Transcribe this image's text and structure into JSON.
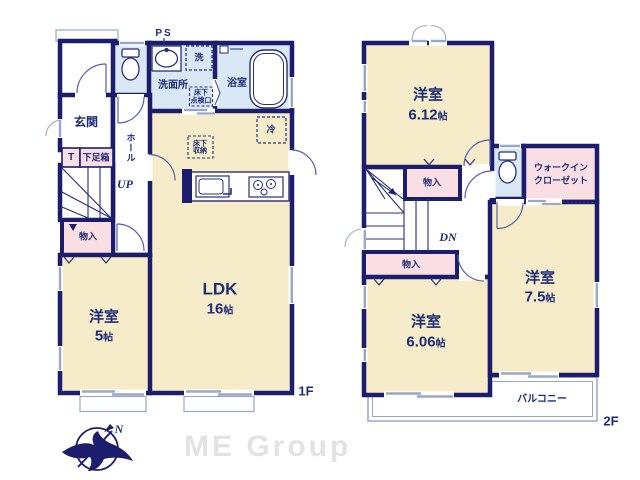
{
  "colors": {
    "wall": "#1d1d6e",
    "room_yellow": "#f7ecca",
    "room_pink": "#f9dee3",
    "room_blue": "#d9e8f4",
    "window_gray": "#9aa8c8",
    "text_navy": "#1e2d78",
    "logo_gray": "#e3e3e3"
  },
  "floor1": {
    "floor_label": "1F",
    "labels": {
      "ps": "PS",
      "entrance": "玄関",
      "t": "T",
      "shoe_box": "下足箱",
      "hall": "ホール",
      "up": "UP",
      "storage": "物入",
      "washroom": "洗面所",
      "laundry": "洗",
      "floor_hatch_line1": "床下",
      "floor_hatch_line2": "点検口",
      "bath": "浴室",
      "fridge": "冷",
      "underfloor_line1": "床下",
      "underfloor_line2": "収納"
    },
    "rooms": {
      "western5": {
        "name": "洋室",
        "size_num": "5",
        "size_unit": "帖"
      },
      "ldk": {
        "name": "LDK",
        "size_num": "16",
        "size_unit": "帖"
      }
    }
  },
  "floor2": {
    "floor_label": "2F",
    "labels": {
      "dn": "DN",
      "storage_upper": "物入",
      "storage_lower": "物入",
      "wic_line1": "ウォークイン",
      "wic_line2": "クローゼット",
      "balcony": "バルコニー"
    },
    "rooms": {
      "western612": {
        "name": "洋室",
        "size_num": "6.12",
        "size_unit": "帖"
      },
      "western75": {
        "name": "洋室",
        "size_num": "7.5",
        "size_unit": "帖"
      },
      "western606": {
        "name": "洋室",
        "size_num": "6.06",
        "size_unit": "帖"
      }
    }
  },
  "footer": {
    "brand": "ME Group",
    "compass_north": "N"
  }
}
